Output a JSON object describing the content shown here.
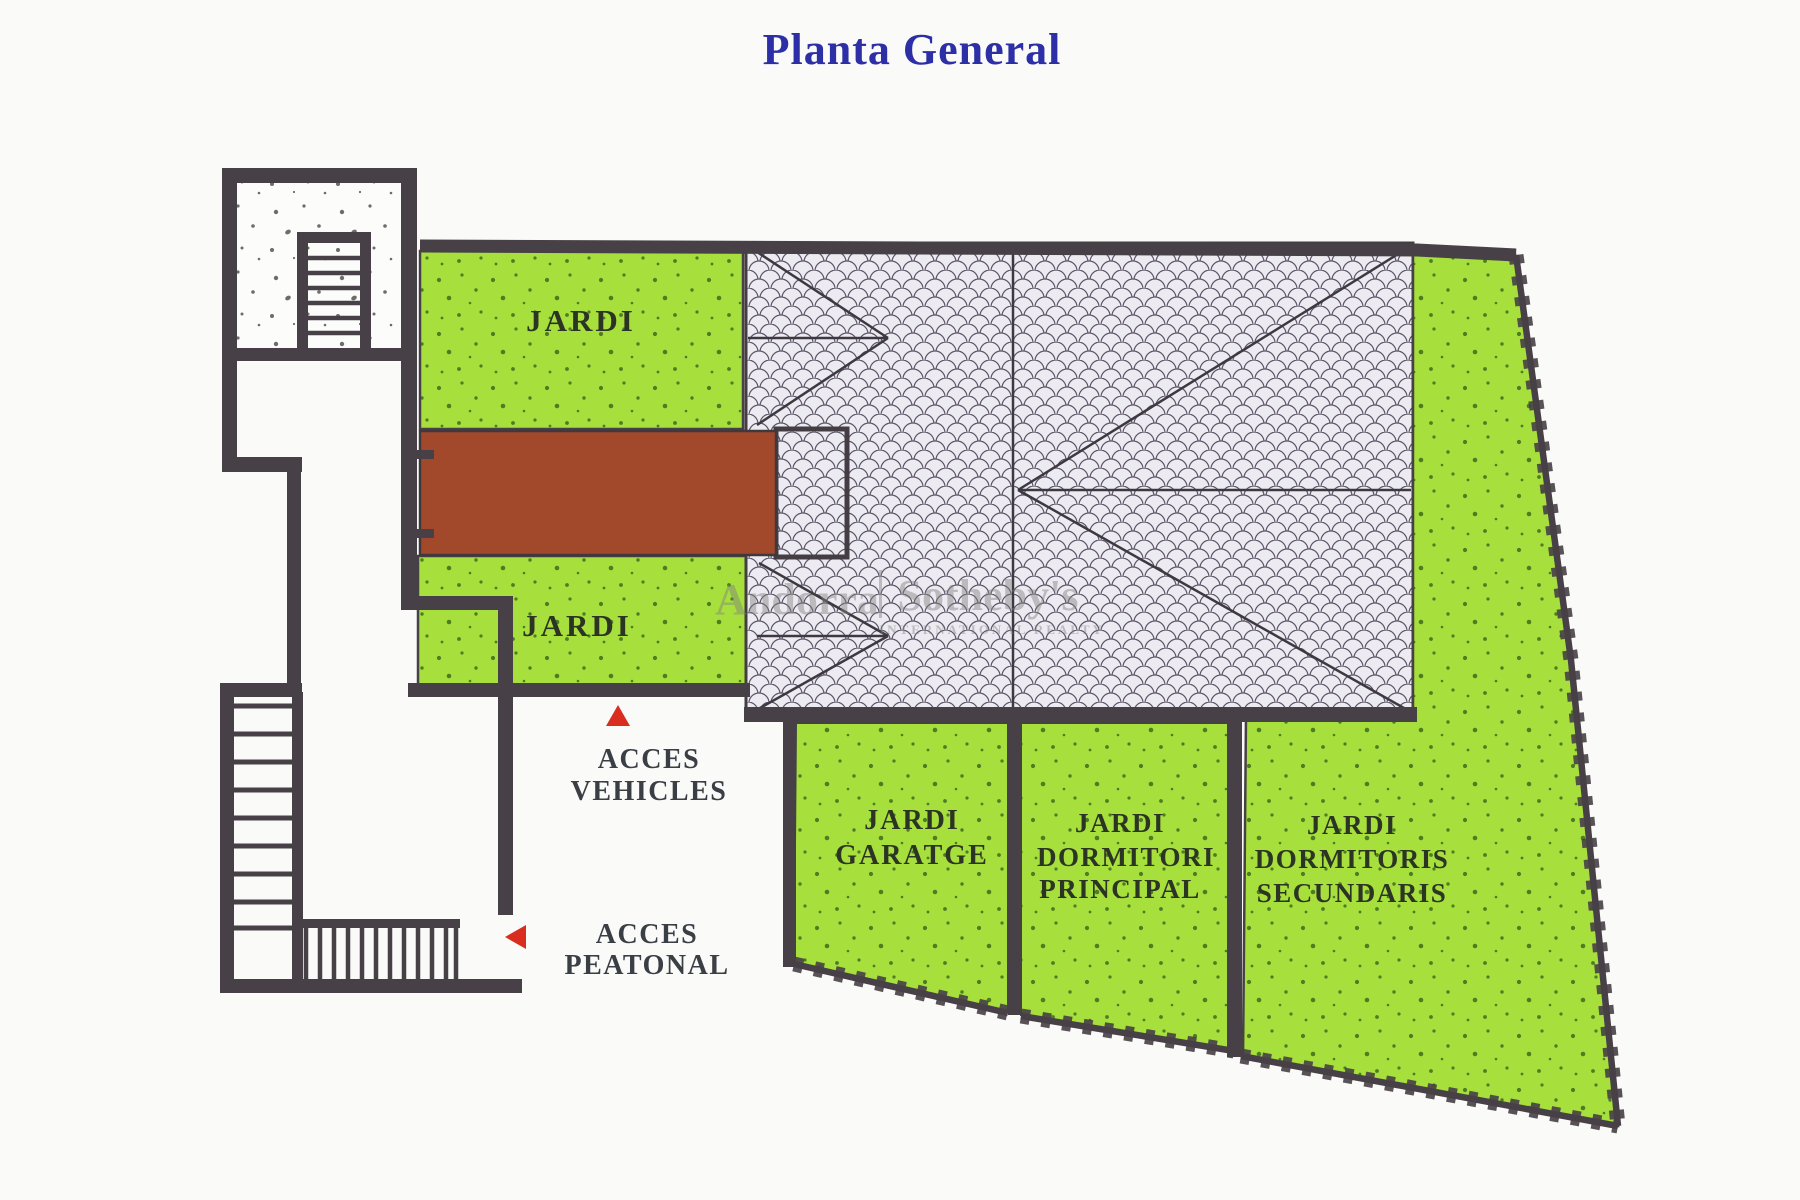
{
  "title": "Planta General",
  "watermark": {
    "brand_left": "Andorra",
    "brand_right": "Sotheby's",
    "brand_sub": "INTERNATIONAL REALTY"
  },
  "areas": {
    "jardi_top": "JARDI",
    "jardi_mid": "JARDI",
    "garatge": [
      "JARDI",
      "GARATGE"
    ],
    "dormitori_principal": [
      "JARDI",
      "DORMITORI",
      "PRINCIPAL"
    ],
    "dormitoris_secundaris": [
      "JARDI",
      "DORMITORIS",
      "SECUNDARIS"
    ]
  },
  "access": {
    "vehicles": [
      "ACCES",
      "VEHICLES"
    ],
    "peatonal": [
      "ACCES",
      "PEATONAL"
    ]
  },
  "colors": {
    "background": "#FAFAF8",
    "garden_green": "#A7DF3C",
    "garden_stipple": "#3E6B1E",
    "terrace_brown": "#A3492B",
    "roof_base": "#ECEAF1",
    "roof_scale_line": "#5C5566",
    "wall_dark": "#474046",
    "title_blue": "#2C2FA5",
    "label_dark": "#2C3424",
    "access_label": "#3A3E45",
    "arrow_red": "#D92D20",
    "watermark_gray": "#7F7F7F"
  }
}
